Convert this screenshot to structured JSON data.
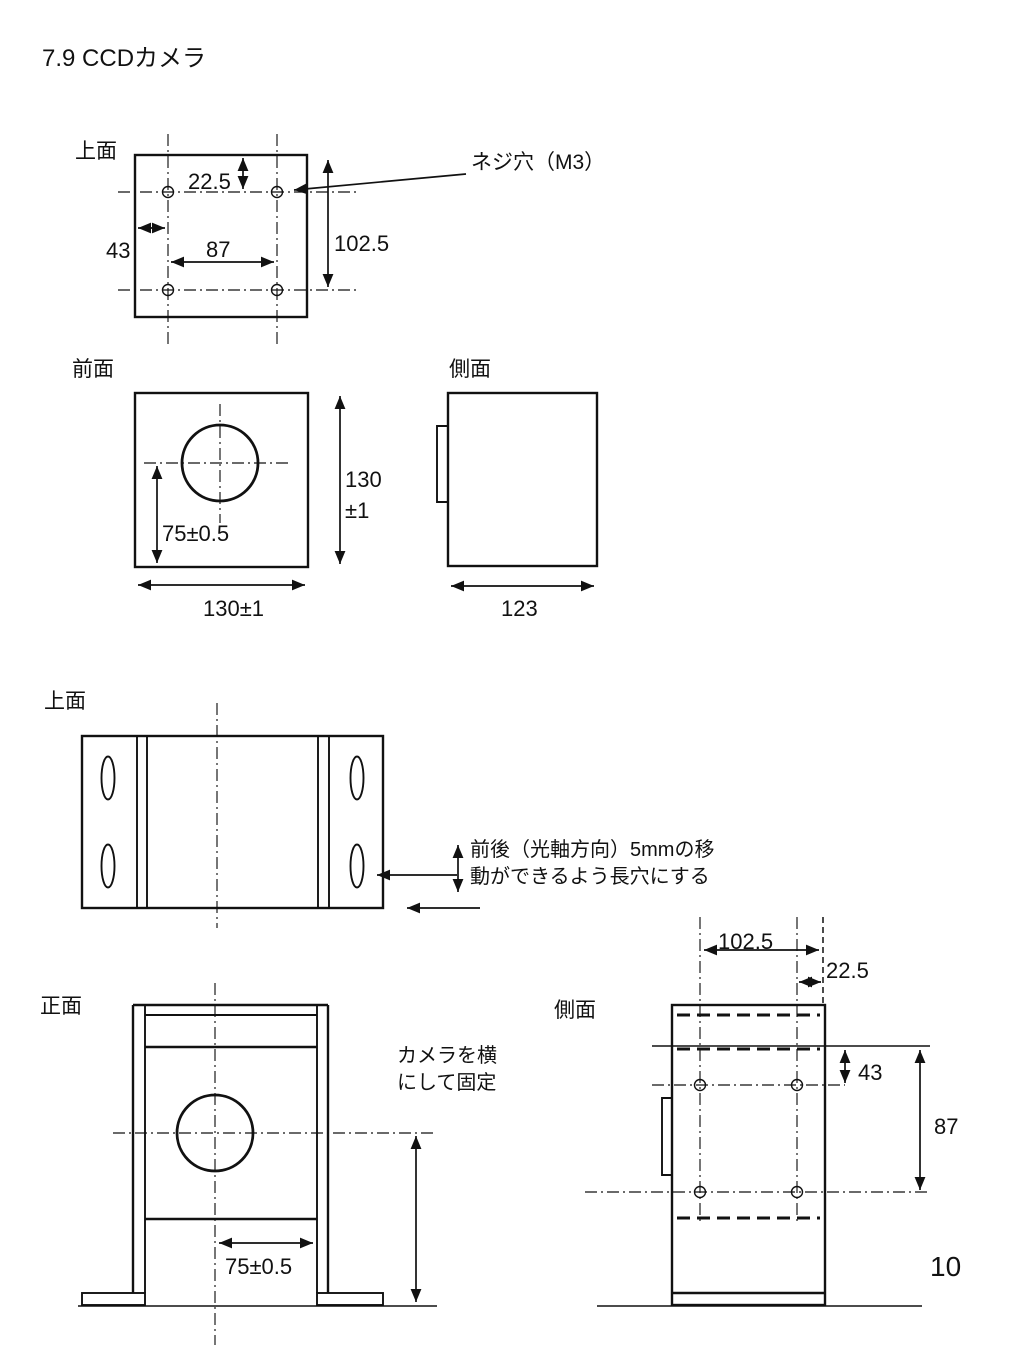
{
  "page": {
    "title": "7.9 CCDカメラ",
    "page_number": "10"
  },
  "camera_top": {
    "label": "上面",
    "dim_edge_to_row1": "22.5",
    "dim_edge_to_col1": "43",
    "dim_col_spacing": "87",
    "dim_edge_to_row2": "102.5",
    "screw_hole_callout": "ネジ穴（M3）"
  },
  "camera_front": {
    "label": "前面",
    "dim_lens_center": "75±0.5",
    "dim_height_value": "130",
    "dim_height_tol": "±1",
    "dim_width": "130±1"
  },
  "camera_side": {
    "label": "側面",
    "dim_depth": "123"
  },
  "bracket_top": {
    "label": "上面",
    "slot_note_line1": "前後（光軸方向）5mmの移",
    "slot_note_line2": "動ができるよう長穴にする"
  },
  "bracket_front": {
    "label": "正面",
    "mount_note_line1": "カメラを横",
    "mount_note_line2": "にして固定",
    "dim_width": "75±0.5"
  },
  "bracket_side": {
    "label": "側面",
    "dim_col_to_face": "102.5",
    "dim_col2_to_face": "22.5",
    "dim_face_to_row1": "43",
    "dim_face_to_row2": "87"
  }
}
